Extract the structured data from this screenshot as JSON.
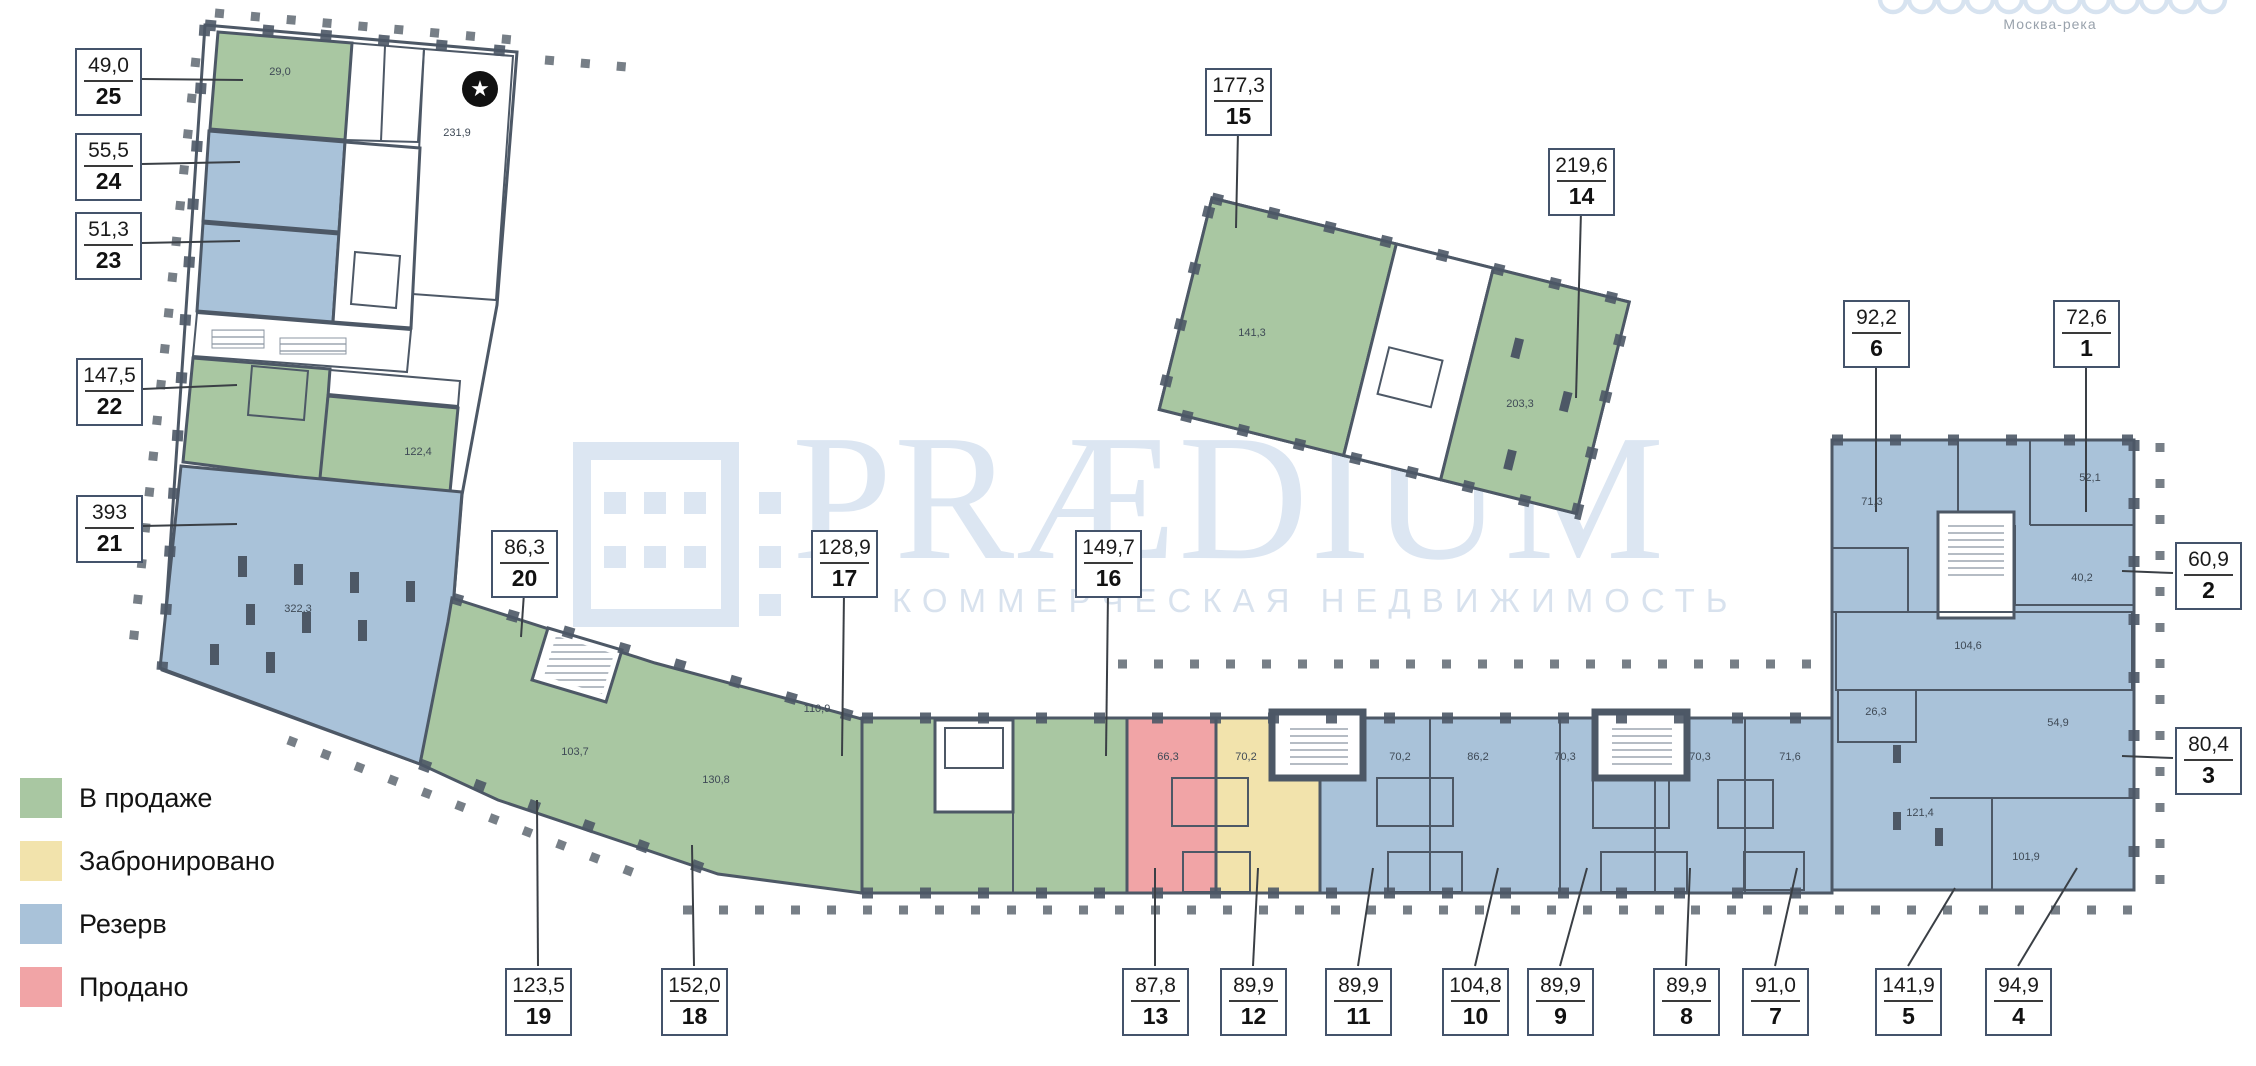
{
  "watermark": {
    "brand": "PRÆDIUM",
    "tagline": "КОММЕРЧЕСКАЯ НЕДВИЖИМОСТЬ"
  },
  "map_note": "Москва-река",
  "colors": {
    "wall": "#4d5866",
    "sale": "#a9c7a2",
    "booked": "#f2e3ac",
    "reserve": "#a9c2d9",
    "sold": "#f1a4a6"
  },
  "legend": {
    "items": [
      {
        "key": "sale",
        "label": "В продаже",
        "color": "#a9c7a2"
      },
      {
        "key": "booked",
        "label": "Забронировано",
        "color": "#f2e3ac"
      },
      {
        "key": "reserve",
        "label": "Резерв",
        "color": "#a9c2d9"
      },
      {
        "key": "sold",
        "label": "Продано",
        "color": "#f1a4a6"
      }
    ]
  },
  "units": [
    {
      "number": "25",
      "area": "49,0",
      "status": "sale",
      "box": [
        75,
        48
      ],
      "tip": [
        243,
        80
      ],
      "side": "r"
    },
    {
      "number": "24",
      "area": "55,5",
      "status": "reserve",
      "box": [
        75,
        133
      ],
      "tip": [
        240,
        162
      ],
      "side": "r"
    },
    {
      "number": "23",
      "area": "51,3",
      "status": "reserve",
      "box": [
        75,
        212
      ],
      "tip": [
        240,
        241
      ],
      "side": "r"
    },
    {
      "number": "22",
      "area": "147,5",
      "status": "sale",
      "box": [
        76,
        358
      ],
      "tip": [
        237,
        385
      ],
      "side": "r"
    },
    {
      "number": "21",
      "area": "393",
      "status": "reserve",
      "box": [
        76,
        495
      ],
      "tip": [
        237,
        524
      ],
      "side": "r"
    },
    {
      "number": "20",
      "area": "86,3",
      "status": "sale",
      "box": [
        491,
        530
      ],
      "tip": [
        521,
        637
      ],
      "side": "b"
    },
    {
      "number": "19",
      "area": "123,5",
      "status": "sale",
      "box": [
        505,
        968
      ],
      "tip": [
        537,
        800
      ],
      "side": "t"
    },
    {
      "number": "18",
      "area": "152,0",
      "status": "sale",
      "box": [
        661,
        968
      ],
      "tip": [
        692,
        845
      ],
      "side": "t"
    },
    {
      "number": "17",
      "area": "128,9",
      "status": "sale",
      "box": [
        811,
        530
      ],
      "tip": [
        842,
        756
      ],
      "side": "b"
    },
    {
      "number": "16",
      "area": "149,7",
      "status": "sale",
      "box": [
        1075,
        530
      ],
      "tip": [
        1106,
        756
      ],
      "side": "b"
    },
    {
      "number": "15",
      "area": "177,3",
      "status": "sale",
      "box": [
        1205,
        68
      ],
      "tip": [
        1236,
        228
      ],
      "side": "b"
    },
    {
      "number": "14",
      "area": "219,6",
      "status": "sale",
      "box": [
        1548,
        148
      ],
      "tip": [
        1576,
        398
      ],
      "side": "b"
    },
    {
      "number": "13",
      "area": "87,8",
      "status": "sold",
      "box": [
        1122,
        968
      ],
      "tip": [
        1155,
        868
      ],
      "side": "t"
    },
    {
      "number": "12",
      "area": "89,9",
      "status": "booked",
      "box": [
        1220,
        968
      ],
      "tip": [
        1258,
        868
      ],
      "side": "t"
    },
    {
      "number": "11",
      "area": "89,9",
      "status": "reserve",
      "box": [
        1325,
        968
      ],
      "tip": [
        1373,
        868
      ],
      "side": "t"
    },
    {
      "number": "10",
      "area": "104,8",
      "status": "reserve",
      "box": [
        1442,
        968
      ],
      "tip": [
        1498,
        868
      ],
      "side": "t"
    },
    {
      "number": "9",
      "area": "89,9",
      "status": "reserve",
      "box": [
        1527,
        968
      ],
      "tip": [
        1587,
        868
      ],
      "side": "t"
    },
    {
      "number": "8",
      "area": "89,9",
      "status": "reserve",
      "box": [
        1653,
        968
      ],
      "tip": [
        1690,
        868
      ],
      "side": "t"
    },
    {
      "number": "7",
      "area": "91,0",
      "status": "reserve",
      "box": [
        1742,
        968
      ],
      "tip": [
        1797,
        868
      ],
      "side": "t"
    },
    {
      "number": "5",
      "area": "141,9",
      "status": "reserve",
      "box": [
        1875,
        968
      ],
      "tip": [
        1955,
        888
      ],
      "side": "t"
    },
    {
      "number": "4",
      "area": "94,9",
      "status": "reserve",
      "box": [
        1985,
        968
      ],
      "tip": [
        2077,
        868
      ],
      "side": "t"
    },
    {
      "number": "6",
      "area": "92,2",
      "status": "reserve",
      "box": [
        1843,
        300
      ],
      "tip": [
        1876,
        512
      ],
      "side": "b"
    },
    {
      "number": "1",
      "area": "72,6",
      "status": "reserve",
      "box": [
        2053,
        300
      ],
      "tip": [
        2086,
        512
      ],
      "side": "b"
    },
    {
      "number": "2",
      "area": "60,9",
      "status": "reserve",
      "box": [
        2175,
        542
      ],
      "tip": [
        2122,
        571
      ],
      "side": "l"
    },
    {
      "number": "3",
      "area": "80,4",
      "status": "reserve",
      "box": [
        2175,
        727
      ],
      "tip": [
        2122,
        756
      ],
      "side": "l"
    }
  ],
  "room_labels": [
    {
      "text": "231,9",
      "x": 457,
      "y": 133
    },
    {
      "text": "29,0",
      "x": 280,
      "y": 72
    },
    {
      "text": "122,4",
      "x": 418,
      "y": 452
    },
    {
      "text": "322,3",
      "x": 298,
      "y": 609
    },
    {
      "text": "103,7",
      "x": 575,
      "y": 752
    },
    {
      "text": "130,8",
      "x": 716,
      "y": 780
    },
    {
      "text": "110,9",
      "x": 817,
      "y": 709
    },
    {
      "text": "66,3",
      "x": 1168,
      "y": 757
    },
    {
      "text": "70,2",
      "x": 1246,
      "y": 757
    },
    {
      "text": "70,2",
      "x": 1400,
      "y": 757
    },
    {
      "text": "86,2",
      "x": 1478,
      "y": 757
    },
    {
      "text": "70,3",
      "x": 1565,
      "y": 757
    },
    {
      "text": "70,3",
      "x": 1700,
      "y": 757
    },
    {
      "text": "71,6",
      "x": 1790,
      "y": 757
    },
    {
      "text": "71,3",
      "x": 1872,
      "y": 502
    },
    {
      "text": "52,1",
      "x": 2090,
      "y": 478
    },
    {
      "text": "40,2",
      "x": 2082,
      "y": 578
    },
    {
      "text": "104,6",
      "x": 1968,
      "y": 646
    },
    {
      "text": "26,3",
      "x": 1876,
      "y": 712
    },
    {
      "text": "54,9",
      "x": 2058,
      "y": 723
    },
    {
      "text": "121,4",
      "x": 1920,
      "y": 813
    },
    {
      "text": "101,9",
      "x": 2026,
      "y": 857
    },
    {
      "text": "141,3",
      "x": 1252,
      "y": 333
    },
    {
      "text": "203,3",
      "x": 1520,
      "y": 404
    }
  ],
  "star_marker": {
    "glyph": "★"
  }
}
